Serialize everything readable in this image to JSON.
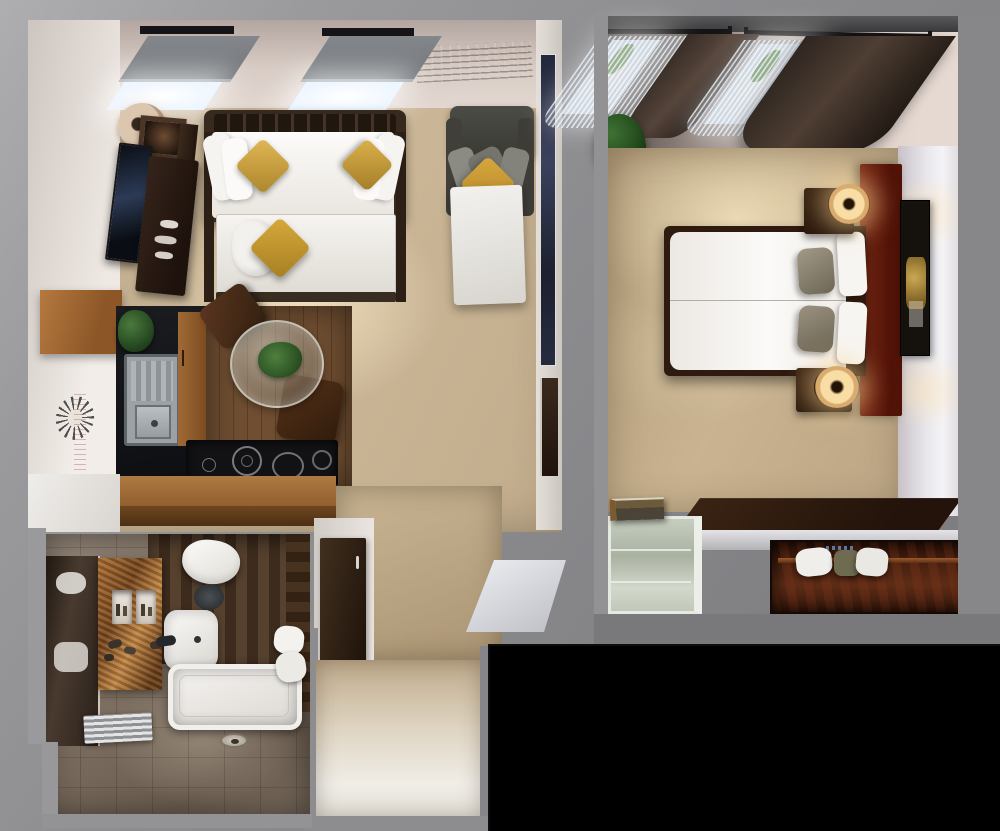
{
  "scene": {
    "title": "Top-down 3D rendered floor plan: studio apartment with kitchenette and bathroom beside a separate double bedroom",
    "view": "bird's-eye cutaway render on a neutral gray mat",
    "units": [
      {
        "name": "studio-living-unit",
        "areas": [
          "sleeping/living area",
          "kitchenette",
          "dining corner",
          "entry corridor"
        ],
        "furniture": [
          "two skylight windows with gray roller blinds",
          "daybed with white mattress, white pillows and two gold accent pillows",
          "trundle bed with white bedding, white pillow and gold accent pillow",
          "gray pull-out sofa bed with gold accent pillow",
          "wall-mounted TV",
          "dark wood media dresser with ornaments",
          "framed picture",
          "drum floor lamp",
          "tall navy wall artwork",
          "entry door (dark wood)",
          "sunburst wall decor",
          "upper wood cabinet",
          "stainless sink with drainboard",
          "wood cabinet column",
          "potted plants",
          "round glass dining table with centerpiece plant",
          "two dark brown dining chairs",
          "black cooktop with burners",
          "wood bar counter"
        ]
      },
      {
        "name": "bathroom",
        "fixtures": [
          "toilet",
          "washbasin with dark faucet",
          "bathtub",
          "walk-in shower floor with drain",
          "heated towel rail",
          "copper mosaic vanity wall with two recessed niches and toiletries",
          "mirror with reflections",
          "rolled white towels",
          "dark wood feature wall",
          "gray-brown floor tiles"
        ]
      },
      {
        "name": "bedroom-unit",
        "furniture": [
          "double bed with white duvet, two white pillows and two taupe accent pillows",
          "full-height mahogany headboard panel",
          "two dark wood nightstands",
          "two glowing ring table lamps",
          "black and gold wall artwork",
          "two curtained windows with sheer curtains and dark drapes",
          "corner plant",
          "dark wood desk ledge",
          "frosted glass cabinet with books on top",
          "open wardrobe niche with clothes rail and hangers"
        ]
      }
    ],
    "void_area": "solid black rectangle at lower right of the render"
  },
  "palette": {
    "background_gray": "#8c8c8f",
    "wall_white": "#e8e2dc",
    "wall_pink": "#d8c9c2",
    "carpet_beige": "#c9b596",
    "wood_dark": "#2f1d10",
    "wood_mid": "#9a6736",
    "mahogany": "#6b2413",
    "bedding_white": "#f6f4f1",
    "accent_gold": "#c79b3b",
    "sofa_gray": "#4a4a45",
    "frosted_glass": "#c3cabc",
    "copper": "#a86e35",
    "void_black": "#000000"
  },
  "watermarks": {
    "ceiling_fine_print": "small illegible dark text block on upper wall",
    "kitchen_wall_text": "small illegible vertical text on kitchen wall"
  }
}
